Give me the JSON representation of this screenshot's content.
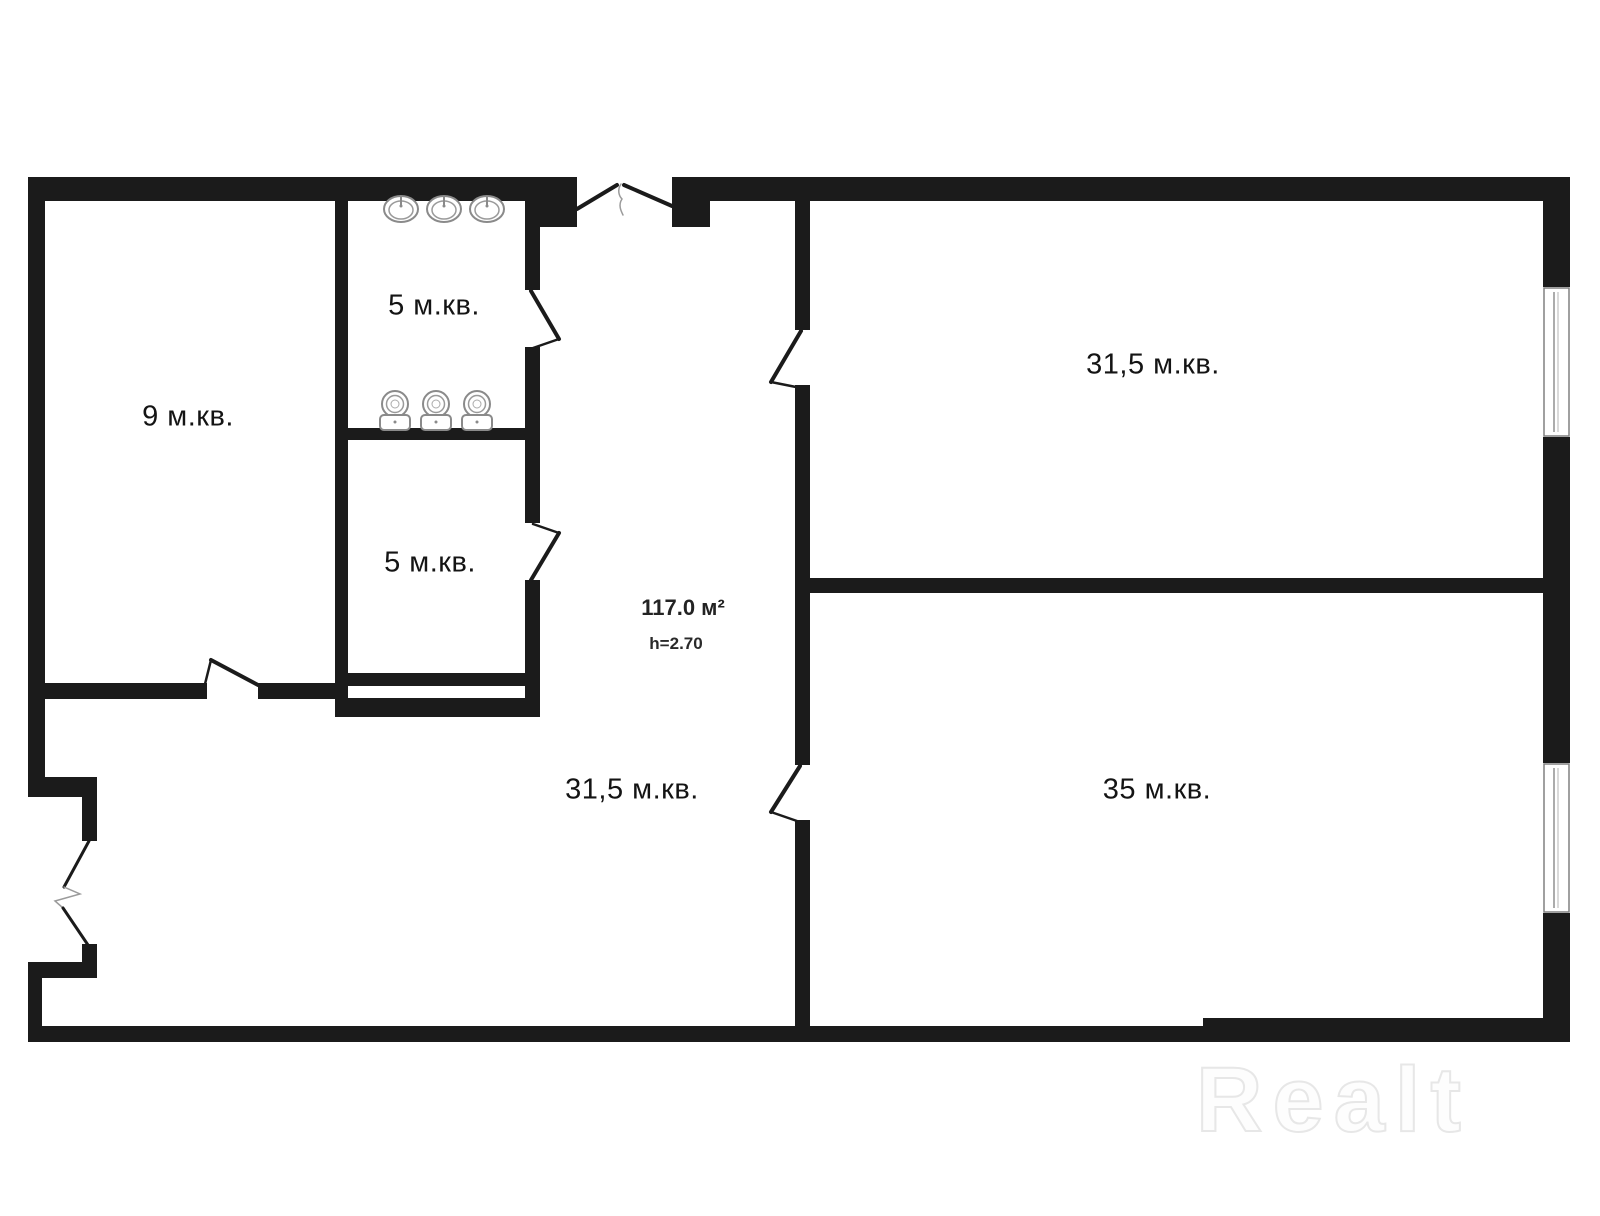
{
  "plan": {
    "rooms": {
      "left": {
        "label": "9 м.кв."
      },
      "wc_top": {
        "label": "5 м.кв."
      },
      "wc_bottom": {
        "label": "5 м.кв."
      },
      "top_right": {
        "label": "31,5 м.кв."
      },
      "hall": {
        "label": "31,5 м.кв."
      },
      "bottom_right": {
        "label": "35 м.кв."
      }
    },
    "summary": {
      "total_area": "117.0 м²",
      "ceiling_height": "h=2.70"
    },
    "fixtures": {
      "sink_count": 3,
      "toilet_count": 3,
      "window_count": 2,
      "door_count": 7
    },
    "colors": {
      "wall": "#1b1b1b",
      "fixture_outline": "#8a8a8a",
      "window_frame": "#808080",
      "watermark": "#e7e7e7"
    }
  },
  "watermark": {
    "text": "Realt"
  }
}
